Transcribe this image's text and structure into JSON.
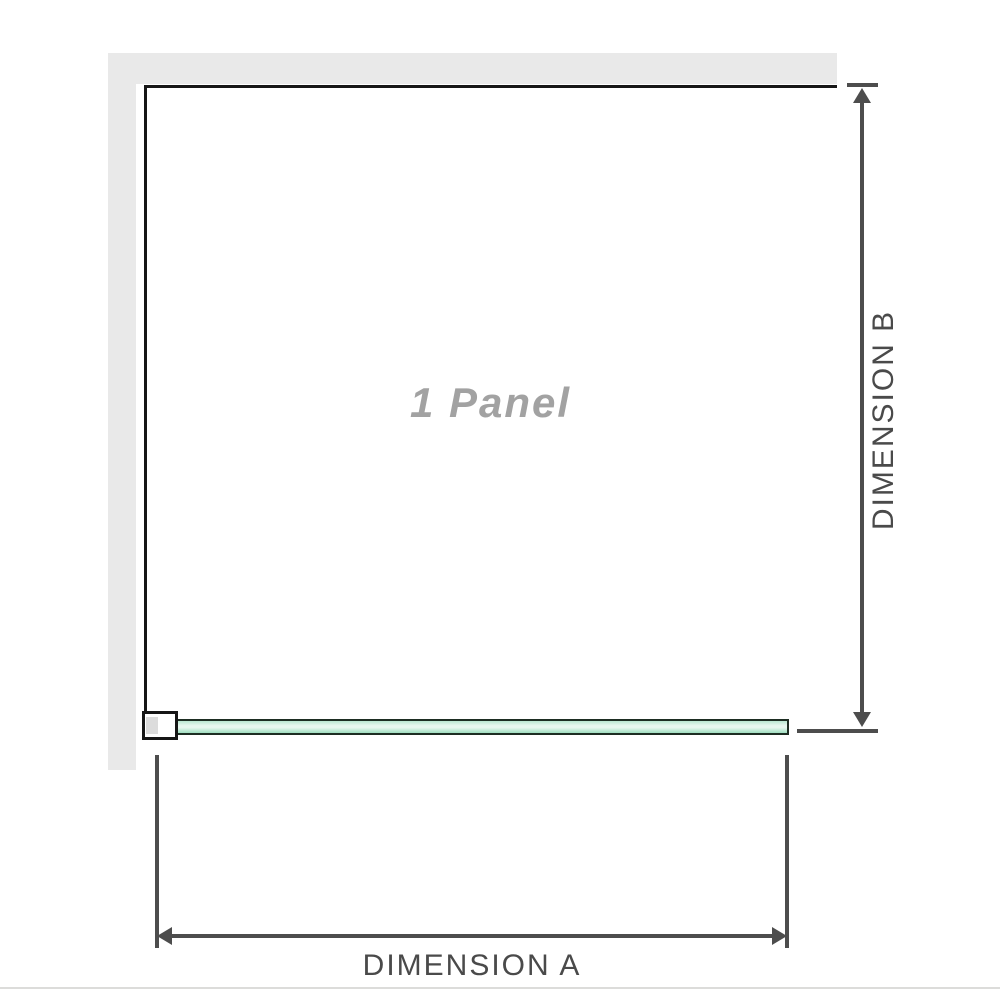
{
  "diagram": {
    "panel_label": "1 Panel",
    "dimension_a_label": "DIMENSION A",
    "dimension_b_label": "DIMENSION B"
  },
  "colors": {
    "wall": "#e9e9e9",
    "outline": "#161616",
    "dimension": "#4d4d4d",
    "label_text": "#4a4a4a",
    "panel_text": "#a2a2a2",
    "glass_edge": "#b9e6d0",
    "glass_light": "#e7f7ee",
    "glass_dark": "#9fdec0",
    "baseline": "#dcdcda"
  }
}
